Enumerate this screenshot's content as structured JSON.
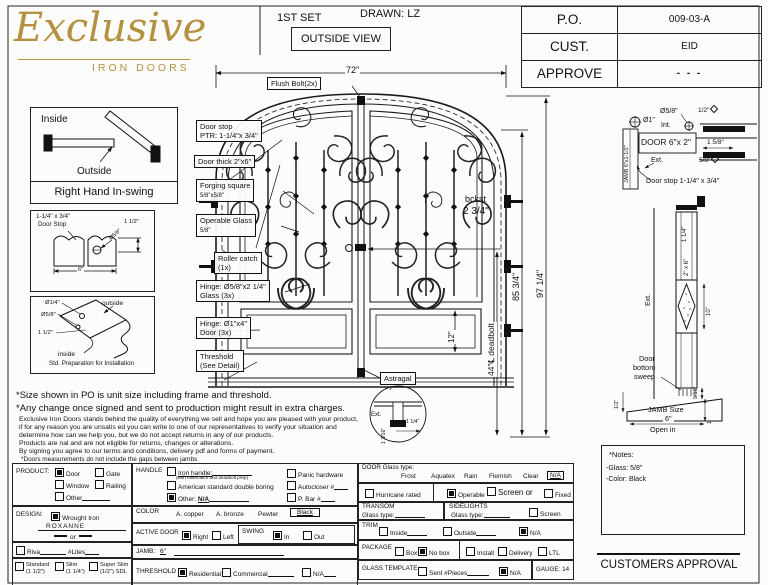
{
  "logo": {
    "name": "Exclusive",
    "tagline": "IRON DOORS"
  },
  "header": {
    "set": "1ST SET",
    "drawn": "DRAWN: LZ",
    "view": "OUTSIDE VIEW"
  },
  "title_block": {
    "po_label": "P.O.",
    "po_value": "009-03-A",
    "cust_label": "CUST.",
    "cust_value": "EID",
    "approve_label": "APPROVE",
    "approve_value": "- - -"
  },
  "swing_panel": {
    "inside": "Inside",
    "outside": "Outside",
    "caption": "Right Hand In-swing"
  },
  "doorstop_panel": {
    "line1": "1-1/4\" x 3/4\"",
    "line2": "Door Stop",
    "dim_h": "1 1/2\"",
    "dim_hole": "Ø5/8\"",
    "dim_w": "6\""
  },
  "prep_panel": {
    "dim1": "Ø1/4\"",
    "dim2": "Ø5/8\"",
    "dim3": "1 1/2\"",
    "outside": "outside",
    "inside": "inside",
    "caption": "Std. Preparation for Installation"
  },
  "door": {
    "dim_width": "72\"",
    "flush_bolt": "Flush Bolt(2x)",
    "door_stop1": "Door stop",
    "door_stop2": "PTR: 1-1/4\"x 3/4\"",
    "door_thick": "Door thick 2\"x6\"",
    "forging1": "Forging square",
    "forging2": "5/8\"x5/8\"",
    "operable1": "Operable Glass",
    "operable2": "5/8\"",
    "roller1": "Roller catch",
    "roller2": "(1x)",
    "hinge_glass1": "Hinge: Ø5/8\"x2 1/4\"",
    "hinge_glass2": "Glass (3x)",
    "hinge_door1": "Hinge: Ø1\"x4\"",
    "hinge_door2": "Door (3x)",
    "threshold1": "Threshold",
    "threshold2": "(See Detail)",
    "astragal": "Astragal",
    "bckst": "bckst",
    "bckst_val": "2 3/4\"",
    "dim_85": "85 3/4\"",
    "dim_97": "97 1/4\"",
    "dim_deadbolt": "44\"℄ deadbolt",
    "dim_12": "12\"",
    "ast_ext": "Ext.",
    "ast_d1": "1 3/16\"",
    "ast_d2": "1 1/4\""
  },
  "side": {
    "dia58": "Ø5/8\"",
    "half": "1/2\"",
    "dia1": "Ø1\"",
    "int_lbl": "Int.",
    "door_lbl": "DOOR 6\"x 2\"",
    "d158": "1 5/8\"",
    "d58": "5/8\"",
    "jamb": "JAMB 6\"x1-1/2\"",
    "ext1": "Ext.",
    "stop": "Door stop 1-1/4\" x 3/4\"",
    "d114": "1 1/4\"",
    "s26": "2\" x 6\"",
    "ext2": "Ext.",
    "d10": "10\"",
    "sweep1": "Door",
    "sweep2": "bottom",
    "sweep3": "sweep",
    "dhalf": "1/2\"",
    "d916": "9/16\"",
    "d112": "1 1/2\"",
    "jamb_size": "JAMB Size",
    "jamb_val": "6\"",
    "open_in": "Open in"
  },
  "notes": {
    "n1": "*Size shown in PO is unit size including frame and threshold.",
    "n2": "*Any change once signed and sent to production might result in extra charges.",
    "body": [
      "Exclusive Iron Doors stands behind the quality of everything we sell and hope you are pleased with your product,",
      "if for any reason you are unsatis ed you can write to one of our representatives to verify your situation and",
      "determine how can we help you, but we do not accept returns in any of our products.",
      "Products are  nal and are not eligible for returns, changes or alterations.",
      "By signing you agree to our terms and conditions, delivery pdf and forms of payment.",
      "*Doors measurements do not include the gaps between jambs"
    ]
  },
  "form": {
    "product": {
      "label": "PRODUCT:",
      "opts": [
        {
          "label": "Door",
          "checked": true
        },
        {
          "label": "Gate",
          "checked": false
        },
        {
          "label": "Window",
          "checked": false
        },
        {
          "label": "Railing",
          "checked": false
        },
        {
          "label": "Other",
          "checked": false
        }
      ]
    },
    "design": {
      "label": "DESIGN:",
      "wrought": "Wrought Iron",
      "wrought_checked": true,
      "value": "ROXANNE",
      "or_lbl": "or",
      "riva": "Riva",
      "lites": "#Lites",
      "t1": "Standard",
      "t1s": "(1 1/2\")",
      "t2": "Slim",
      "t2s": "(1 1/4\")",
      "t3": "Super Slim",
      "t3s": "(1/2\") SDL"
    },
    "handle": {
      "label": "HANDLE",
      "iron": "Iron handle:",
      "iron_sub": "(with rollercatch and deadbolt prep)",
      "american": "American standard double boring",
      "other": "Other:",
      "other_val": "N/A",
      "other_checked": true,
      "panic": "Panic hardware",
      "autocloser": "Autocloser #",
      "pbar": "P. Bar #"
    },
    "color": {
      "label": "COLOR",
      "c1": "A. copper",
      "c2": "A. bronze",
      "c3": "Pewter",
      "selected": "Black"
    },
    "active": {
      "label": "ACTIVE DOOR",
      "right": "Right",
      "right_checked": true,
      "left": "Left",
      "swing": "SWING",
      "in_lbl": "In",
      "in_checked": true,
      "out": "Out"
    },
    "jamb": {
      "label": "JAMB:",
      "value": "6\""
    },
    "threshold": {
      "label": "THRESHOLD",
      "residential": "Residential",
      "residential_checked": true,
      "commercial": "Commercial",
      "na": "N/A"
    },
    "glass": {
      "label": "DOOR Glass type:",
      "opts": [
        "Frost",
        "Aquatex",
        "Rain",
        "Flemish",
        "Clear"
      ],
      "na": "N/A",
      "hurricane": "Hurricane rated",
      "operable": "Operable",
      "operable_checked": true,
      "screen_or": "Screen or",
      "fixed": "Fixed"
    },
    "transom": {
      "label": "TRANSOM",
      "glass_type": "Glass type:"
    },
    "sidelights": {
      "label": "SIDELIGHTS",
      "glass_type": "Glass type:",
      "screen": "Screen"
    },
    "trim": {
      "label": "TRIM",
      "inside": "Inside",
      "outside": "Outside",
      "na": "N/A",
      "na_checked": true
    },
    "pack": {
      "label": "PACKAGE",
      "box": "Box",
      "nobox": "No box",
      "nobox_checked": true,
      "install": "Install",
      "delivery": "Delivery",
      "ltl": "LTL"
    },
    "template": {
      "label": "GLASS TEMPLATE",
      "sent": "Sent #Pieces",
      "na": "N/A",
      "na_checked": true
    },
    "gauge": "GAUGE: 14"
  },
  "corner_notes": {
    "title": "*Notes:",
    "glass": "-Glass: 5/8\"",
    "color": "-Color: Black"
  },
  "approval": "CUSTOMERS APPROVAL"
}
